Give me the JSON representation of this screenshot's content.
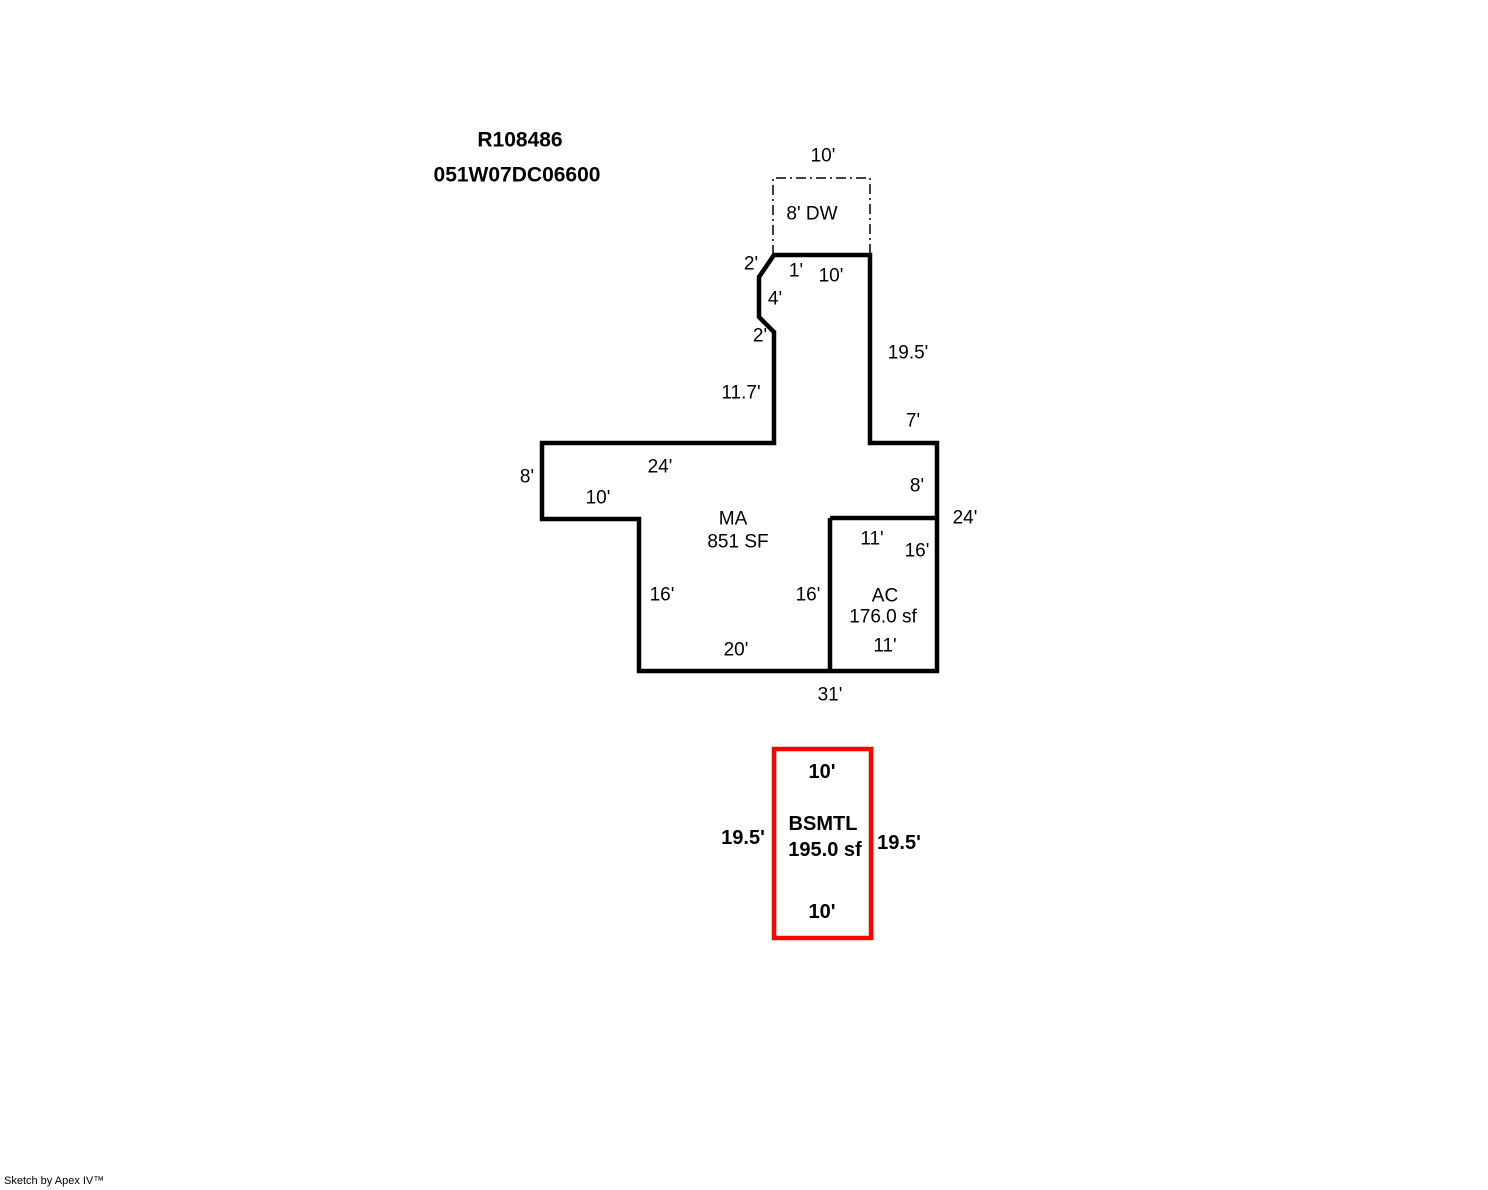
{
  "header": {
    "parcel_id": "R108486",
    "map_taxlot": "051W07DC06600"
  },
  "footer": {
    "credit": "Sketch by Apex IV™"
  },
  "colors": {
    "line": "#000000",
    "basement_accent": "#ff0000"
  },
  "areas": {
    "main": {
      "code": "MA",
      "size": "851 SF"
    },
    "ac": {
      "code": "AC",
      "size": "176.0 sf"
    },
    "driveway": {
      "label": "8' DW"
    },
    "basement": {
      "code": "BSMTL",
      "size": "195.0 sf"
    }
  },
  "dims": {
    "dw_top_width": "10'",
    "notch_upper": "2'",
    "top_inset": "1'",
    "top_width": "10'",
    "notch_mid": "4'",
    "notch_lower": "2'",
    "stem_left": "11.7'",
    "stem_right": "19.5'",
    "right_jog": "7'",
    "upper_left_width": "24'",
    "upper_left_height": "8'",
    "left_step_width": "10'",
    "right_upper": "8'",
    "right_total": "24'",
    "ac_top": "11'",
    "ac_right": "16'",
    "left_lower": "16'",
    "ac_left": "16'",
    "bottom_main": "20'",
    "ac_bottom": "11'",
    "bottom_total": "31'",
    "bsmt_top": "10'",
    "bsmt_left": "19.5'",
    "bsmt_right": "19.5'",
    "bsmt_bottom": "10'"
  }
}
